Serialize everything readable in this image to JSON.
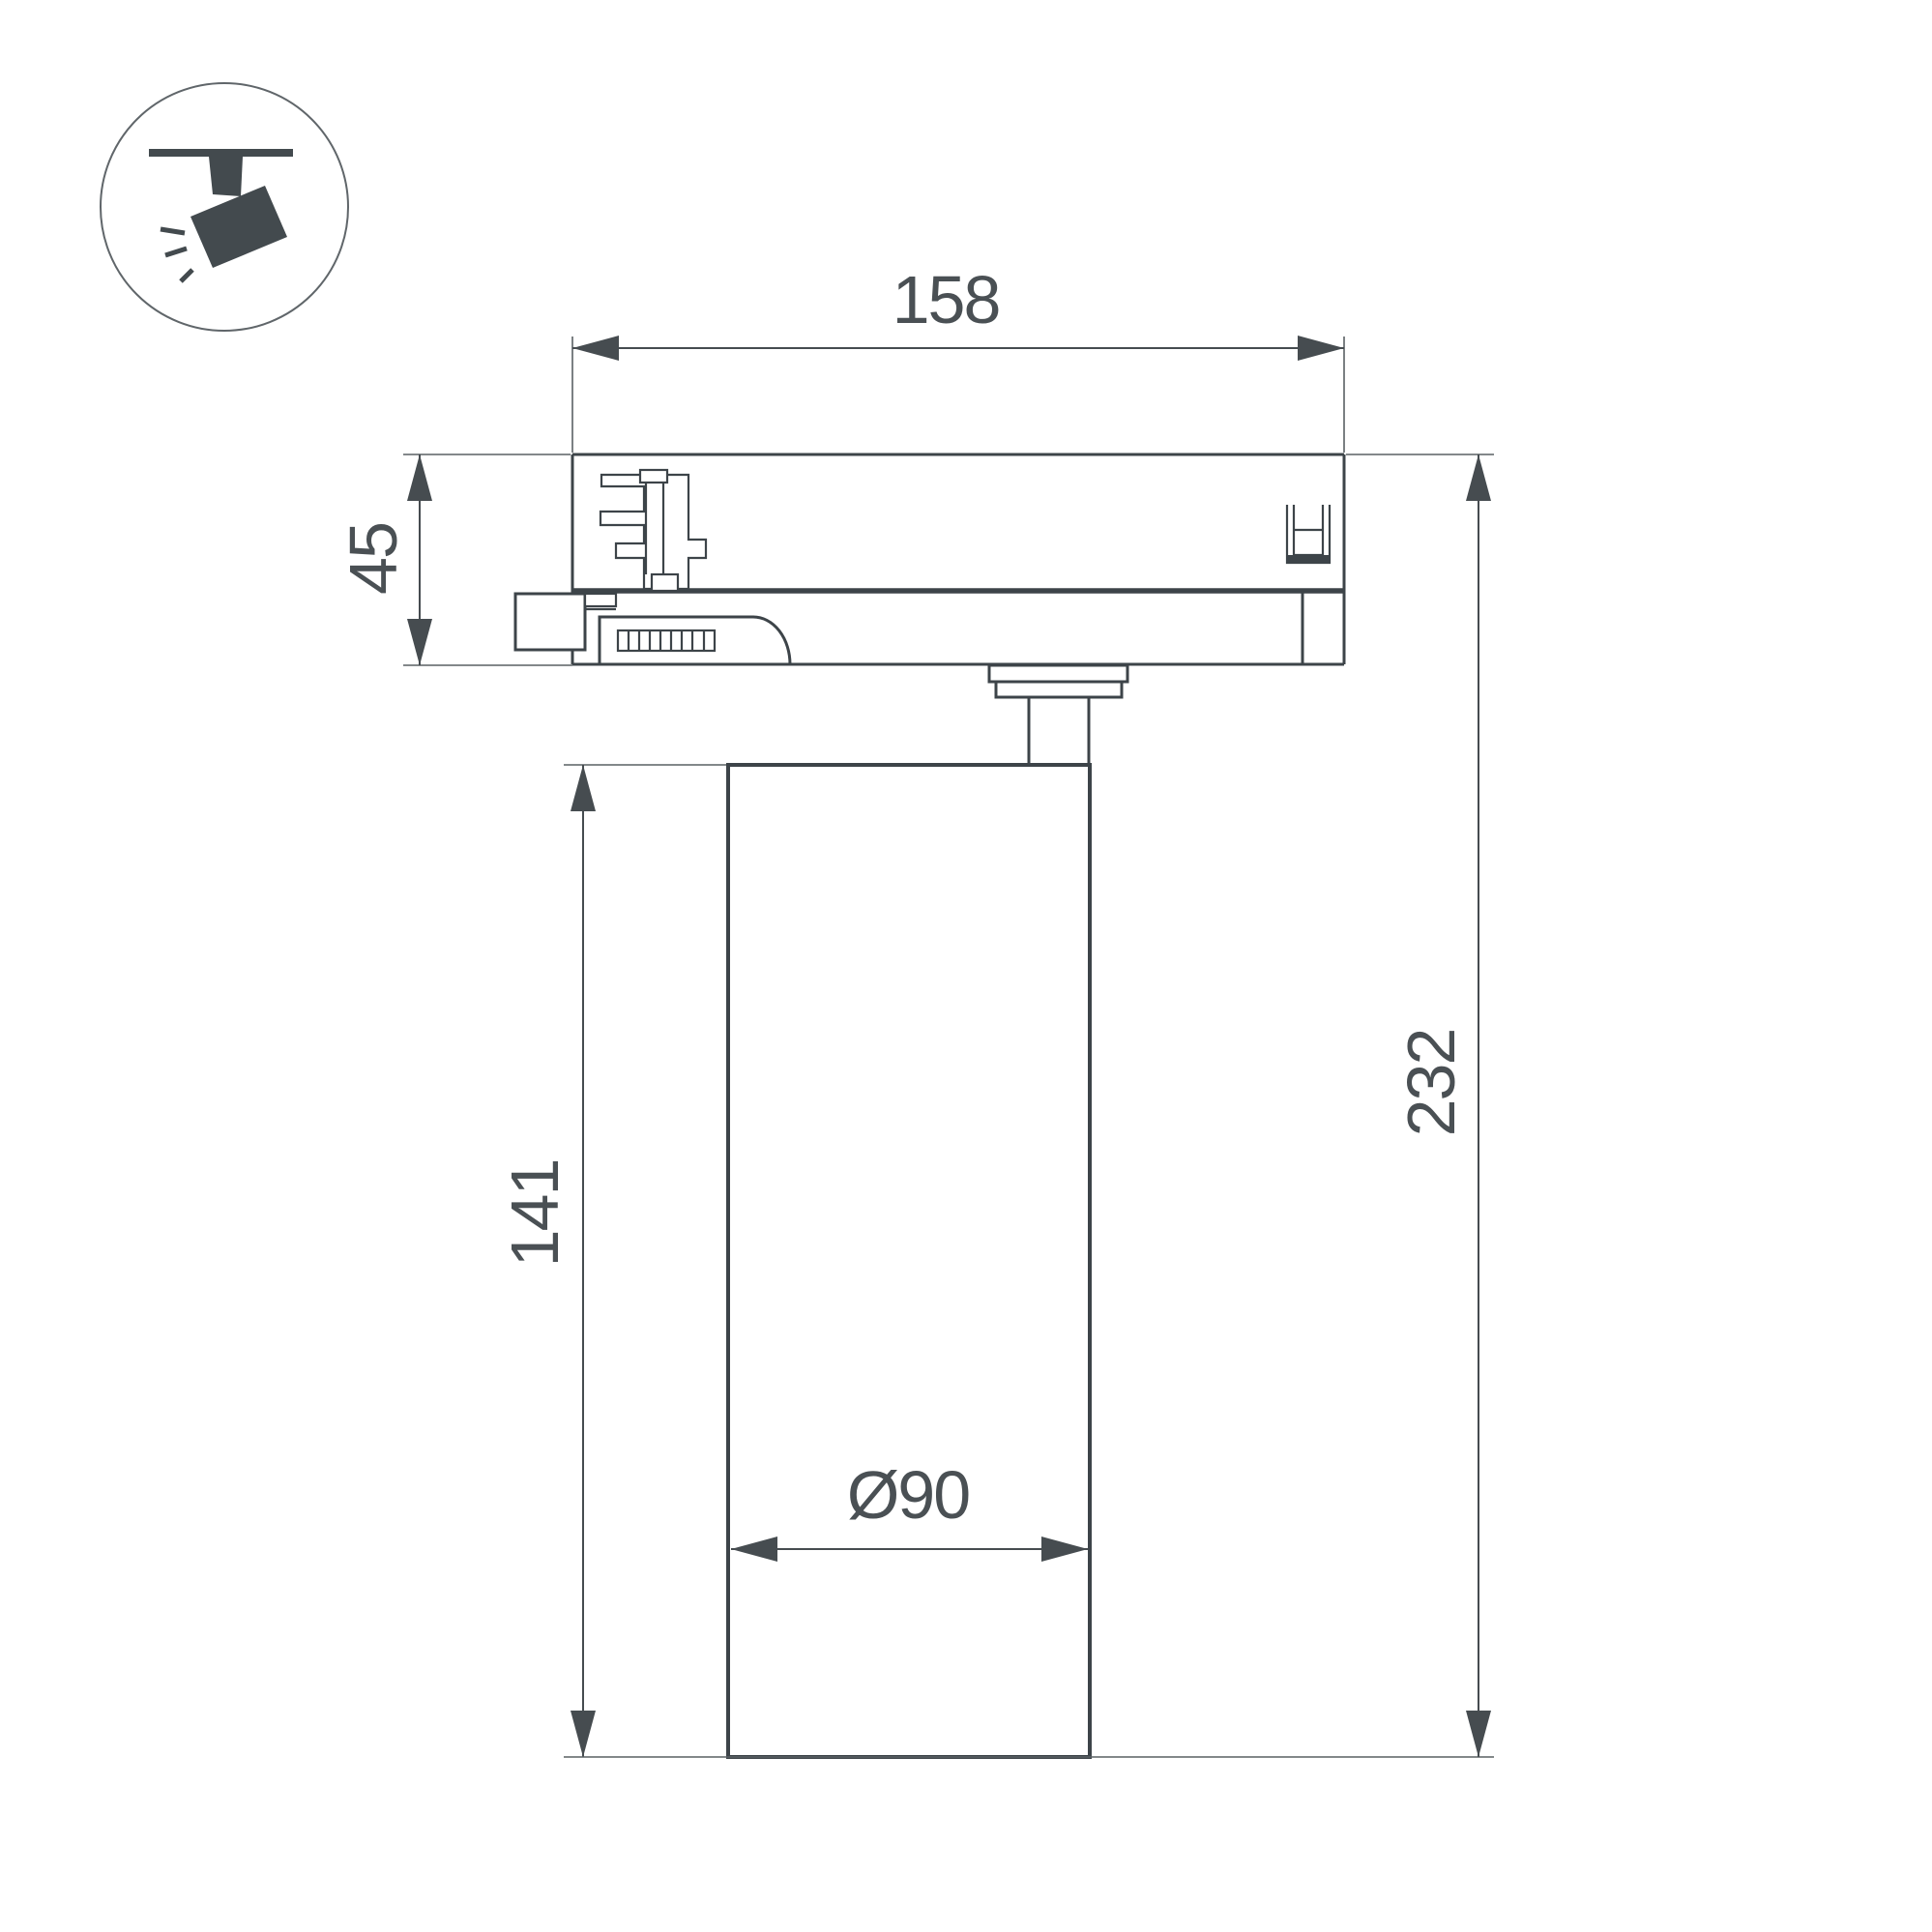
{
  "title": "Track spotlight technical dimension drawing",
  "colors": {
    "background": "#ffffff",
    "line": "#3d4449",
    "dim": "#464c50",
    "ext": "#5a6064",
    "text": "#4a5054",
    "icon": "#434a4e",
    "icon_circle": "#60666a"
  },
  "icon": {
    "name": "ceiling-track-spotlight-icon"
  },
  "labels": {
    "adapter_width": "158",
    "adapter_height": "45",
    "body_height": "141",
    "total_height": "232",
    "diameter": "Ø90"
  }
}
